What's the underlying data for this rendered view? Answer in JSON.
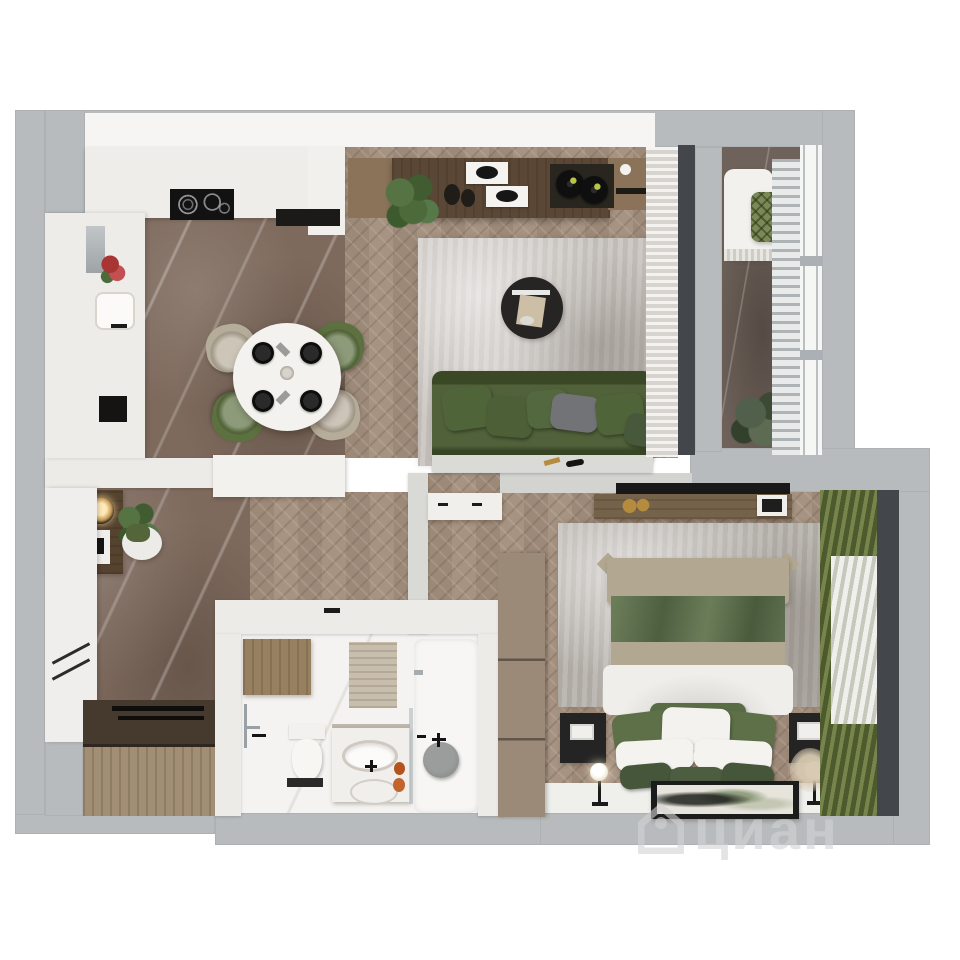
{
  "watermark": {
    "text": "циан",
    "logo": "cian-house-logo"
  },
  "palette": {
    "background": "#ffffff",
    "wall-outer": "#b8bbbd",
    "wall-inner": "#ecebe8",
    "floor-wood": "#a3907f",
    "floor-marble": "#7e6a5d",
    "floor-balcony": "#6e625a",
    "bath-floor": "#f4f3f1",
    "rug-living": "#c8c3be",
    "rug-bedroom": "#b5b0aa",
    "sofa-green": "#46582e",
    "pillow-green": "#52663a",
    "chair-green": "#5c7040",
    "chair-beige": "#b6ac9a",
    "table-white": "#f3f2ef",
    "wood-dark": "#5a4735",
    "wood-mid": "#8a7358",
    "wood-light": "#a18e73",
    "curtain-white": "#e9e7e3",
    "curtain-green-a": "#77854c",
    "curtain-green-b": "#4c5a2d",
    "frame-dark": "#43464a",
    "bed-beige": "#b2a791",
    "duvet-white": "#efeeea",
    "black": "#1b1b1b",
    "white-furn": "#f0efec",
    "gold": "#b58b3e",
    "watermark": "rgba(210,210,210,0.6)"
  },
  "scene": {
    "type": "apartment-floor-plan-3d-top-view",
    "rooms": [
      {
        "name": "kitchen-dining",
        "items": [
          "kitchen-counter",
          "cooktop",
          "sink",
          "fridge",
          "red-flowers",
          "round-dining-table",
          "four-black-plates",
          "two-green-chairs",
          "two-beige-chairs",
          "marble-floor"
        ]
      },
      {
        "name": "living-room",
        "items": [
          "tv-console",
          "plant",
          "vases",
          "trays",
          "record-player",
          "gray-rug",
          "round-coffee-table",
          "green-sofa",
          "gray-cushion",
          "white-curtains",
          "herringbone-floor"
        ]
      },
      {
        "name": "balcony",
        "items": [
          "white-lounge-chair",
          "lattice-cushion",
          "plant",
          "radiator",
          "window-wall",
          "marble-floor"
        ]
      },
      {
        "name": "bedroom",
        "items": [
          "double-bed-green-white",
          "two-black-nightstands",
          "two-floor-lamps",
          "wall-tv",
          "wood-shelf",
          "gold-decor",
          "gray-rug",
          "wardrobe",
          "green-curtains",
          "sheer-curtain",
          "framed-artwork",
          "pampas-grass"
        ]
      },
      {
        "name": "bathroom",
        "items": [
          "toilet",
          "vanity-with-sink",
          "mirror-reflection-sink",
          "shower-stool",
          "glass-partition",
          "bathtub",
          "wood-cabinet",
          "towel-rail",
          "orange-bottles",
          "bath-mat",
          "door-handle"
        ]
      },
      {
        "name": "hallway",
        "items": [
          "entry-console",
          "two-pendant-lamps",
          "green-plant",
          "white-pouf",
          "white-wardrobe",
          "wood-bench",
          "marble-floor"
        ]
      }
    ]
  }
}
